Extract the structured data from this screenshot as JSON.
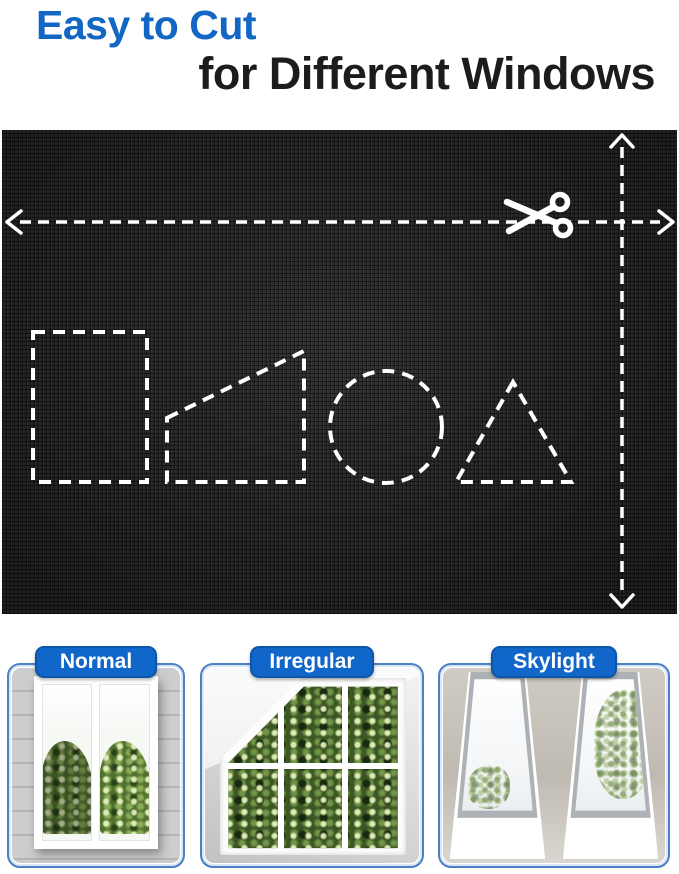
{
  "title": {
    "line1": "Easy to Cut",
    "line2": "for Different Windows"
  },
  "colors": {
    "accent_blue": "#1266c4",
    "title_black": "#1c1c1c",
    "fabric_base": "#262626",
    "dash_white": "#ffffff",
    "card_border": "#4b80c2",
    "label_bg": "#1167c9",
    "label_text": "#ffffff"
  },
  "fabric_panel": {
    "icons": [
      "scissors-icon",
      "left-arrow-icon",
      "right-arrow-icon",
      "up-arrow-icon",
      "down-arrow-icon"
    ],
    "cut_guides": {
      "horizontal": "dashed cut line across full width with arrowheads at both ends and scissors",
      "vertical": "dashed cut line down full height with arrowheads at both ends"
    },
    "cut_shapes": [
      {
        "name": "rectangle"
      },
      {
        "name": "trapezoid"
      },
      {
        "name": "circle"
      },
      {
        "name": "triangle"
      }
    ]
  },
  "window_examples": [
    {
      "label": "Normal"
    },
    {
      "label": "Irregular"
    },
    {
      "label": "Skylight"
    }
  ]
}
